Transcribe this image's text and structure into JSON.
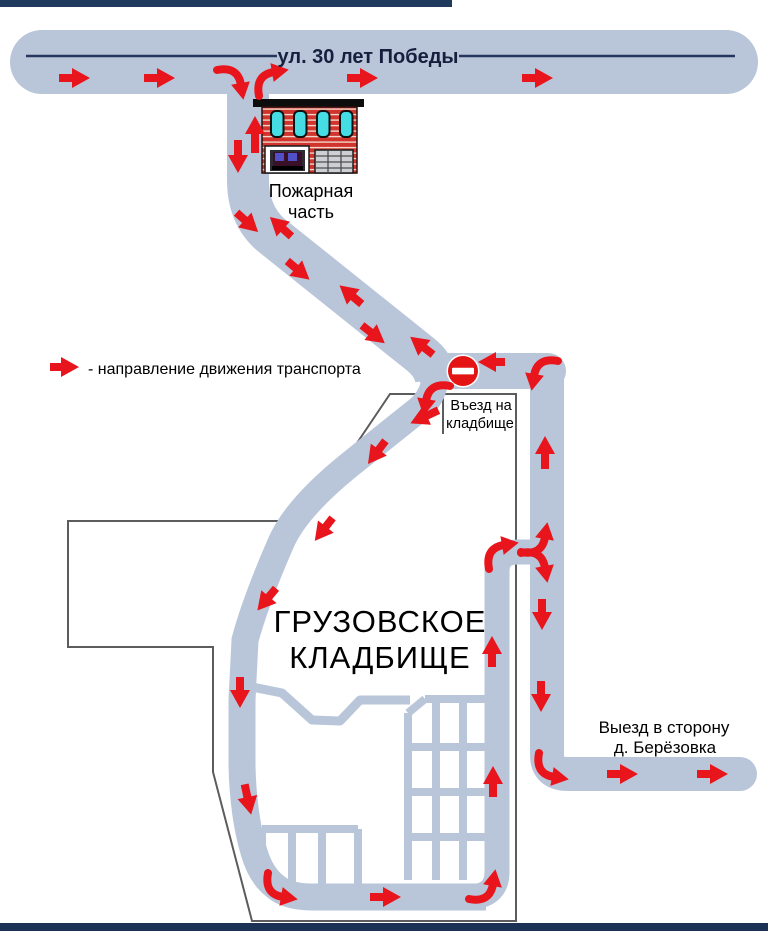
{
  "street": {
    "name": "ул. 30 лет Победы"
  },
  "fire_station": {
    "line1": "Пожарная",
    "line2": "часть"
  },
  "legend": {
    "text": "- направление движения транспорта"
  },
  "cemetery": {
    "line1": "ГРУЗОВСКОЕ",
    "line2": "КЛАДБИЩЕ"
  },
  "entrance": {
    "line1": "Въезд на",
    "line2": "кладбище"
  },
  "exit": {
    "line1": "Выезд в сторону",
    "line2": "д. Берёзовка"
  },
  "signs": {
    "no_entry": "no-entry (кирпич)"
  },
  "colors": {
    "road": "#b9c6d9",
    "arrow": "#e8151c",
    "navy_bar": "#203a5e",
    "center_line": "#26365c",
    "outline": "#5c5c5c",
    "no_entry_red": "#e41414",
    "building_red": "#d0342c",
    "window_cyan": "#46dce4"
  },
  "arrows": [
    {
      "name": "legend-arrow",
      "type": "straight",
      "x": 64,
      "y": 367,
      "angle": 0,
      "len": 14
    },
    {
      "type": "straight",
      "x": 75,
      "y": 78,
      "angle": 0,
      "len": 16
    },
    {
      "type": "straight",
      "x": 160,
      "y": 78,
      "angle": 0,
      "len": 16
    },
    {
      "type": "curve",
      "x": 234,
      "y": 81,
      "rot": 90
    },
    {
      "type": "curve",
      "x": 270,
      "y": 79,
      "rot": 0
    },
    {
      "type": "straight",
      "x": 363,
      "y": 78,
      "angle": 0,
      "len": 16
    },
    {
      "type": "straight",
      "x": 538,
      "y": 78,
      "angle": 0,
      "len": 16
    },
    {
      "type": "straight",
      "x": 238,
      "y": 158,
      "angle": 90,
      "len": 18
    },
    {
      "type": "straight",
      "x": 255,
      "y": 131,
      "angle": -90,
      "len": 22
    },
    {
      "type": "straight",
      "x": 247,
      "y": 222,
      "angle": 42,
      "len": 14
    },
    {
      "type": "straight",
      "x": 281,
      "y": 227,
      "angle": -138,
      "len": 14
    },
    {
      "type": "straight",
      "x": 298,
      "y": 270,
      "angle": 40,
      "len": 14
    },
    {
      "type": "straight",
      "x": 351,
      "y": 295,
      "angle": -140,
      "len": 14
    },
    {
      "type": "straight",
      "x": 373,
      "y": 334,
      "angle": 38,
      "len": 14
    },
    {
      "type": "straight",
      "x": 422,
      "y": 346,
      "angle": -142,
      "len": 14
    },
    {
      "type": "straight",
      "x": 493,
      "y": 362,
      "angle": 180,
      "len": 12
    },
    {
      "type": "curve",
      "x": 541,
      "y": 372,
      "rot": 270,
      "flip": true
    },
    {
      "type": "curve",
      "x": 433,
      "y": 397,
      "rot": 270,
      "flip": true
    },
    {
      "type": "straight",
      "x": 424,
      "y": 417,
      "angle": 155,
      "len": 16
    },
    {
      "type": "straight",
      "x": 377,
      "y": 452,
      "angle": 127,
      "len": 14
    },
    {
      "type": "straight",
      "x": 324,
      "y": 529,
      "angle": 128,
      "len": 14
    },
    {
      "type": "straight",
      "x": 267,
      "y": 599,
      "angle": 130,
      "len": 14
    },
    {
      "type": "straight",
      "x": 240,
      "y": 693,
      "angle": 90,
      "len": 16
    },
    {
      "type": "straight",
      "x": 248,
      "y": 800,
      "angle": 78,
      "len": 16
    },
    {
      "type": "curve",
      "x": 279,
      "y": 890,
      "rot": 180,
      "flip": true
    },
    {
      "type": "straight",
      "x": 386,
      "y": 897,
      "angle": 0,
      "len": 16
    },
    {
      "type": "curve",
      "x": 486,
      "y": 888,
      "rot": 90,
      "flip": true
    },
    {
      "type": "straight",
      "x": 493,
      "y": 781,
      "angle": -90,
      "len": 16
    },
    {
      "type": "straight",
      "x": 492,
      "y": 651,
      "angle": -90,
      "len": 16
    },
    {
      "type": "curve",
      "x": 500,
      "y": 552,
      "rot": 0
    },
    {
      "type": "curve",
      "x": 538,
      "y": 541,
      "rot": 90,
      "flip": true
    },
    {
      "type": "curve",
      "x": 538,
      "y": 564,
      "rot": 90
    },
    {
      "type": "straight",
      "x": 545,
      "y": 451,
      "angle": -90,
      "len": 18
    },
    {
      "type": "straight",
      "x": 542,
      "y": 615,
      "angle": 90,
      "len": 16
    },
    {
      "type": "straight",
      "x": 541,
      "y": 697,
      "angle": 90,
      "len": 16
    },
    {
      "type": "curve",
      "x": 550,
      "y": 770,
      "rot": 180,
      "flip": true
    },
    {
      "type": "straight",
      "x": 623,
      "y": 774,
      "angle": 0,
      "len": 16
    },
    {
      "type": "straight",
      "x": 713,
      "y": 774,
      "angle": 0,
      "len": 16
    }
  ]
}
